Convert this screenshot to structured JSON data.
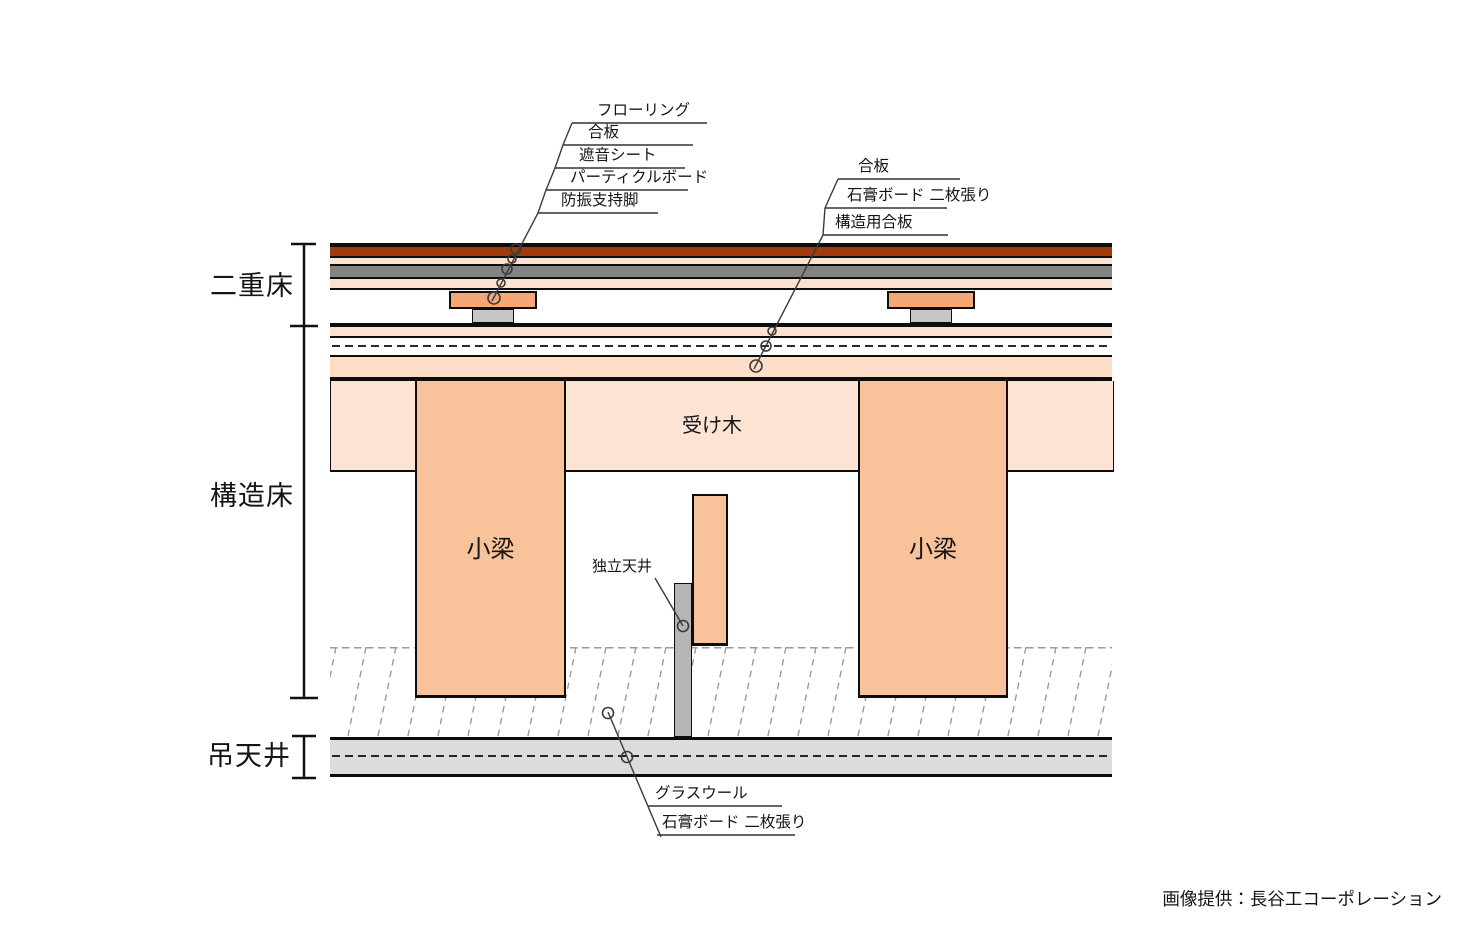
{
  "sections": {
    "double_floor": "二重床",
    "structural_floor": "構造床",
    "suspended_ceiling": "吊天井"
  },
  "top_labels": [
    "フローリング",
    "合板",
    "遮音シート",
    "パーティクルボード",
    "防振支持脚"
  ],
  "right_labels": [
    "合板",
    "石膏ボード 二枚張り",
    "構造用合板"
  ],
  "bottom_labels": [
    "グラスウール",
    "石膏ボード 二枚張り"
  ],
  "inner_labels": {
    "receiving_wood": "受け木",
    "small_beam_left": "小梁",
    "small_beam_right": "小梁",
    "independent_ceiling": "独立天井"
  },
  "credit": "画像提供：長谷工コーポレーション",
  "colors": {
    "flooring": "#9e3a0c",
    "plywood": "#fae1d0",
    "sound_insulation_sheet": "#838383",
    "structural_plywood": "#fbddc8",
    "receiving_wood_band": "#fce3d3",
    "vibration_support_leg": "#f5a876",
    "leg_foot": "#c6c6c6",
    "small_beam": "#f8c29a",
    "ceiling_post": "#b5b5b5",
    "ceiling_board_band": "#dcdcdc",
    "hatch_glass_wool": "#9a9a9a",
    "line": "#0d0d0d"
  }
}
